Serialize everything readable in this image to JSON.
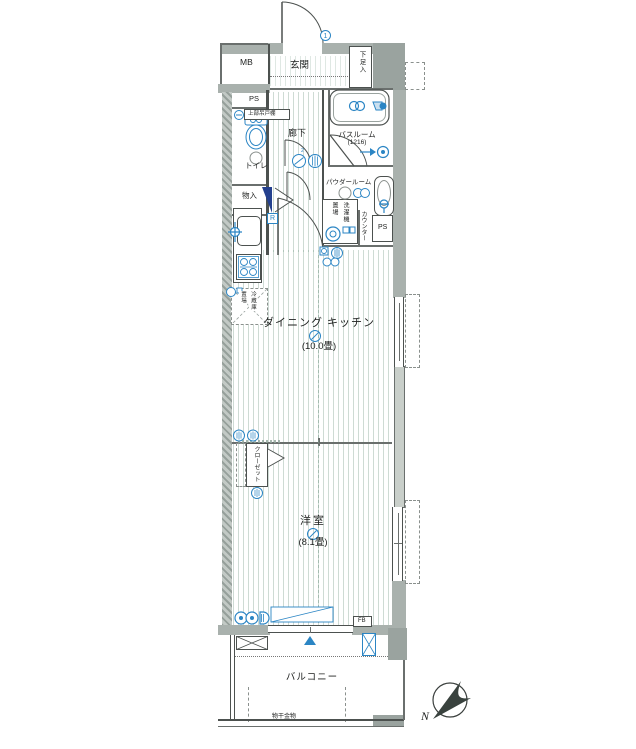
{
  "colors": {
    "wall": "#a9b1ad",
    "wall_light": "#c9cfca",
    "accent_blue": "#2b85c4",
    "navy": "#24408e",
    "needle": "#39423e",
    "line": "#4c514f"
  },
  "rooms": {
    "mb": "MB",
    "genkan": "玄関",
    "shoe_box": "下足入",
    "ps_top": "PS",
    "upper_cabinet": "上部吊戸棚",
    "toilet": "トイレ",
    "hallway": "廊下",
    "bathroom": {
      "name": "バスルーム",
      "size": "(1216)"
    },
    "storage": "物入",
    "powder_room": "パウダールーム",
    "washer": {
      "line1": "洗濯機",
      "line2": "置場"
    },
    "counter": "カウンター",
    "ps_mid": "PS",
    "refrigerator_mark": "R",
    "fridge": {
      "line1": "冷蔵庫",
      "line2": "置場"
    },
    "dining_kitchen": {
      "name": "ダイニング キッチン",
      "size": "(10.0畳)"
    },
    "closet": "クローゼット",
    "bedroom": {
      "name": "洋室",
      "size": "(8.1畳)"
    },
    "fb": "FB",
    "balcony": "バルコニー",
    "laundry_hardware": "物干金物"
  },
  "markers": {
    "entry_door_note": "1",
    "hall_note_sup": "2"
  },
  "compass": {
    "north": "N"
  }
}
